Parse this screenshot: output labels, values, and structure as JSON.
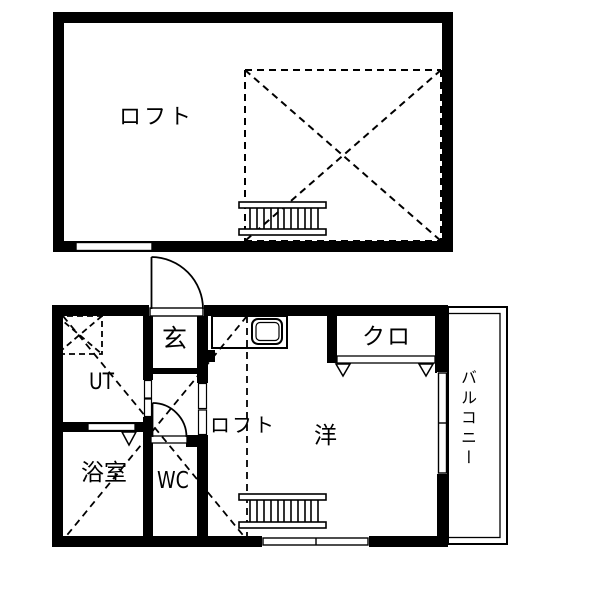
{
  "document": {
    "type": "japanese-apartment-floor-plan",
    "floors": [
      "loft-level",
      "main-level"
    ]
  },
  "labels": {
    "loft_upper": "ロフト",
    "entrance": "玄",
    "utility": "UT",
    "bath": "浴室",
    "wc": "WC",
    "loft_lower": "ロフト",
    "western_room": "洋",
    "closet": "クロ",
    "balcony": "バルコニー"
  },
  "icons": {
    "stairs": "ladder-stairs",
    "sink": "kitchen-sink-counter",
    "swing_door": "quarter-arc-door",
    "sliding_door": "white-slot-track",
    "folding_door_marker": "down-triangle",
    "void_area": "dashed-x-cross",
    "laundry_space": "dashed-x-box"
  },
  "colors": {
    "wall": "#000000",
    "background": "#ffffff",
    "line": "#000000"
  }
}
